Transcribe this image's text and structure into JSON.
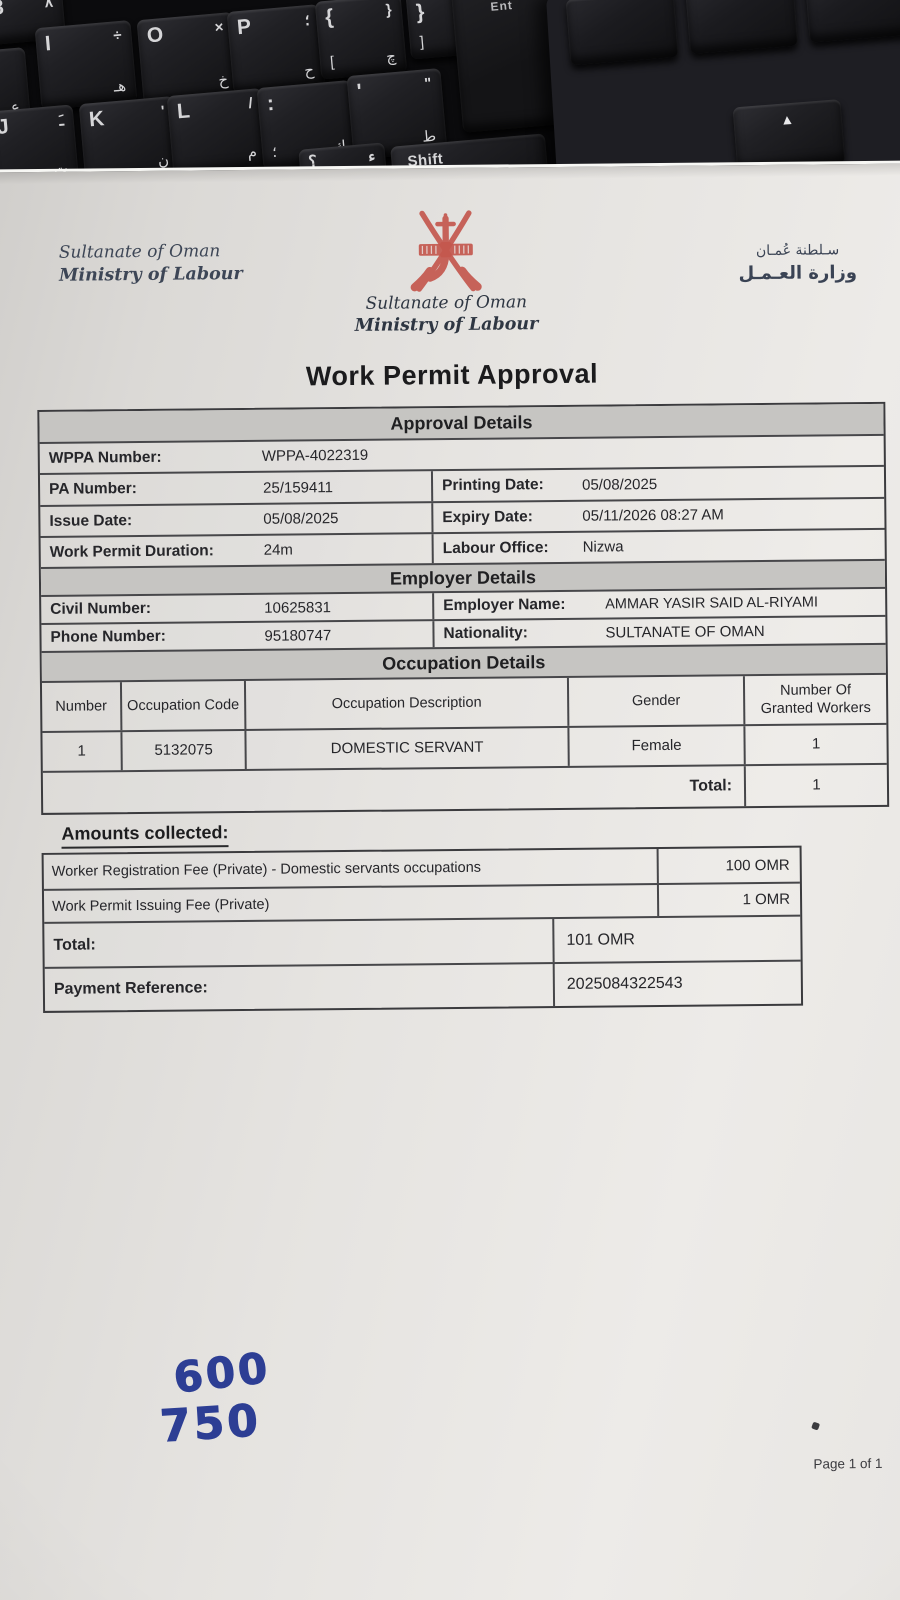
{
  "keyboard": {
    "keys": [
      {
        "id": "key-8",
        "main": "8",
        "alt": "٨",
        "sub": ""
      },
      {
        "id": "key-i",
        "main": "I",
        "alt": "÷",
        "sub": "هـ"
      },
      {
        "id": "key-o",
        "main": "O",
        "alt": "×",
        "sub": "خ"
      },
      {
        "id": "key-p",
        "main": "P",
        "alt": "؛",
        "sub": "ح"
      },
      {
        "id": "key-brace-open",
        "main": "{",
        "alt": "}",
        "sub2": "[",
        "sub": "چ"
      },
      {
        "id": "key-brace-close",
        "main": "}",
        "alt": "{",
        "sub2": "]",
        "sub": ""
      },
      {
        "id": "key-ain",
        "main": "",
        "alt": "",
        "sub": "ع"
      },
      {
        "id": "key-j",
        "main": "J",
        "alt": "ـَ",
        "sub": "ت"
      },
      {
        "id": "key-k",
        "main": "K",
        "alt": "'",
        "sub": "ن"
      },
      {
        "id": "key-l",
        "main": "L",
        "alt": "/",
        "sub": "م"
      },
      {
        "id": "key-semicolon",
        "main": ":",
        "alt": "",
        "sub2": "؛",
        "sub": "ك"
      },
      {
        "id": "key-quote",
        "main": "'",
        "alt": "\"",
        "sub": "ط"
      },
      {
        "id": "key-question",
        "main": "؟",
        "alt": "ء",
        "sub": ""
      }
    ],
    "shift_label": "Shift",
    "enter_label": "Ent",
    "arrow_up_glyph": "▲"
  },
  "doc": {
    "header": {
      "left": {
        "line1": "Sultanate of Oman",
        "line2": "Ministry of Labour"
      },
      "center": {
        "line1": "Sultanate of Oman",
        "line2": "Ministry of Labour"
      },
      "right": {
        "line1": "سـلطنة عُمـان",
        "line2": "وزارة العـمـل"
      },
      "emblem_color": "#c4574e"
    },
    "title": "Work Permit Approval",
    "approval_details": {
      "section_title": "Approval Details",
      "wppa_label": "WPPA Number:",
      "wppa_value": "WPPA-4022319",
      "pa_label": "PA Number:",
      "pa_value": "25/159411",
      "printing_label": "Printing Date:",
      "printing_value": "05/08/2025",
      "issue_label": "Issue Date:",
      "issue_value": "05/08/2025",
      "expiry_label": "Expiry Date:",
      "expiry_value": "05/11/2026 08:27 AM",
      "duration_label": "Work Permit Duration:",
      "duration_value": "24m",
      "office_label": "Labour Office:",
      "office_value": "Nizwa"
    },
    "employer_details": {
      "section_title": "Employer Details",
      "civil_label": "Civil Number:",
      "civil_value": "10625831",
      "employer_label": "Employer Name:",
      "employer_value": "AMMAR YASIR SAID AL-RIYAMI",
      "phone_label": "Phone Number:",
      "phone_value": "95180747",
      "nationality_label": "Nationality:",
      "nationality_value": "SULTANATE OF OMAN"
    },
    "occupation_details": {
      "section_title": "Occupation Details",
      "headers": [
        "Number",
        "Occupation Code",
        "Occupation Description",
        "Gender",
        "Number Of Granted Workers"
      ],
      "rows": [
        [
          "1",
          "5132075",
          "DOMESTIC SERVANT",
          "Female",
          "1"
        ]
      ],
      "total_label": "Total:",
      "total_value": "1"
    },
    "amounts": {
      "heading": "Amounts collected:",
      "fees": [
        {
          "description": "Worker Registration Fee (Private) - Domestic servants occupations",
          "amount": "100 OMR"
        },
        {
          "description": "Work Permit Issuing Fee (Private)",
          "amount": "1 OMR"
        }
      ],
      "total_label": "Total:",
      "total_value": "101 OMR",
      "payment_ref_label": "Payment Reference:",
      "payment_ref_value": "2025084322543"
    },
    "handwriting": {
      "line1": "600",
      "line2": "750",
      "ink_color": "#2d3e94"
    },
    "footer": {
      "page": "Page 1 of 1"
    }
  }
}
